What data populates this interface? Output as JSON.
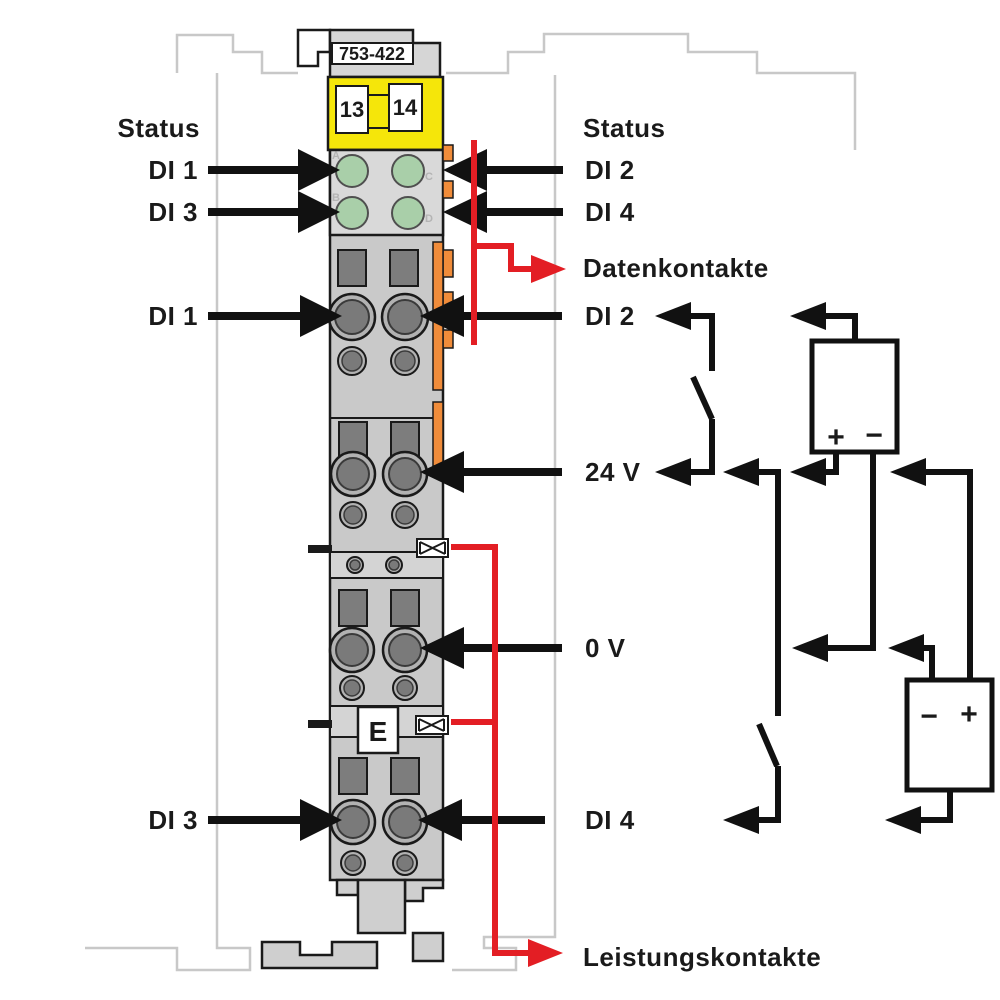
{
  "module": {
    "part_number": "753-422",
    "clamp_numbers": [
      "13",
      "14"
    ],
    "earth_label": "E",
    "led_labels": [
      "A",
      "B",
      "C",
      "D"
    ]
  },
  "left_labels": {
    "status": "Status",
    "di1_led": "DI 1",
    "di3_led": "DI 3",
    "di1_terminal": "DI 1",
    "di3_terminal": "DI 3"
  },
  "right_labels": {
    "status": "Status",
    "di2_led": "DI 2",
    "di4_led": "DI 4",
    "data_contacts": "Datenkontakte",
    "di2_terminal": "DI 2",
    "v24": "24 V",
    "v0": "0 V",
    "di4_terminal": "DI 4",
    "power_contacts": "Leistungskontakte"
  },
  "circuit": {
    "supply_top": {
      "plus": "+",
      "minus": "−"
    },
    "supply_bottom": {
      "minus": "−",
      "plus": "+"
    }
  },
  "colors": {
    "red": "#e31e24",
    "orange": "#f08c3a",
    "yellow": "#f5e60a",
    "led_green": "#a9cfa9",
    "module_gray": "#c9c9c9",
    "outline_gray": "#c8c8c8"
  }
}
